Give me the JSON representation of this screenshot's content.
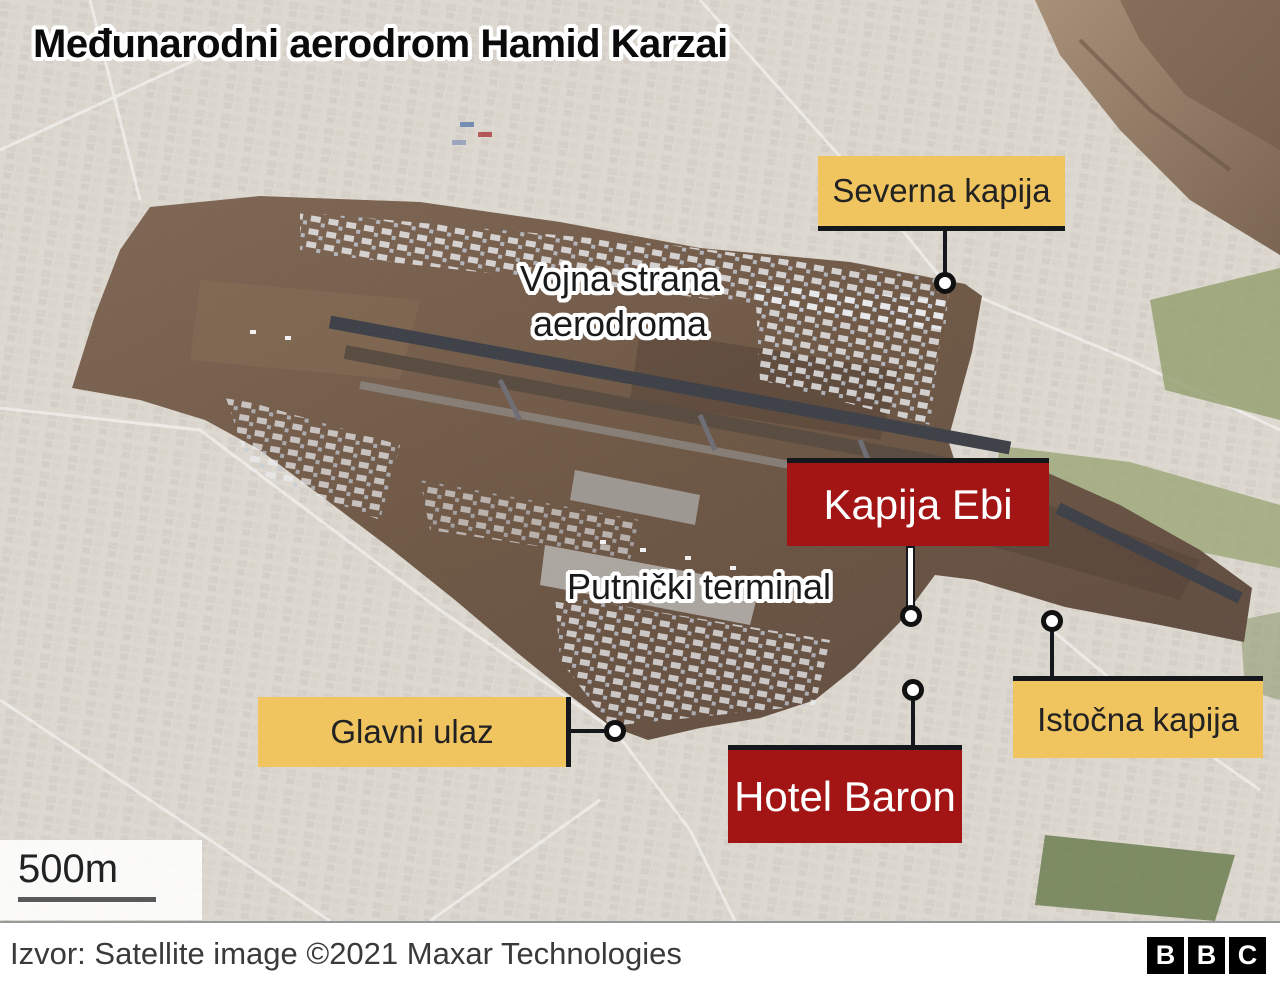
{
  "title": "Međunarodni aerodrom Hamid Karzai",
  "annotations": {
    "military_side": {
      "line1": "Vojna strana",
      "line2": "aerodroma"
    },
    "passenger_terminal": "Putnički terminal"
  },
  "labels": {
    "north_gate": {
      "text": "Severna kapija",
      "style": "gate"
    },
    "abbey_gate": {
      "text": "Kapija Ebi",
      "style": "alert"
    },
    "main_entrance": {
      "text": "Glavni ulaz",
      "style": "gate"
    },
    "hotel_baron": {
      "text": "Hotel Baron",
      "style": "alert"
    },
    "east_gate": {
      "text": "Istočna kapija",
      "style": "gate"
    }
  },
  "scale": {
    "label": "500m"
  },
  "footer": {
    "source": "Izvor: Satellite image ©2021 Maxar Technologies",
    "logo_letters": [
      "B",
      "B",
      "C"
    ]
  },
  "colors": {
    "gate_label_bg": "#F0C45F",
    "alert_label_bg": "#A31414",
    "label_text_dark": "#222222",
    "label_text_light": "#FFFFFF",
    "leader_line": "#14181C",
    "marker_fill": "#FFFFFF",
    "marker_ring": "#111111",
    "scale_line": "#595959",
    "footer_bg": "#FFFFFF"
  }
}
